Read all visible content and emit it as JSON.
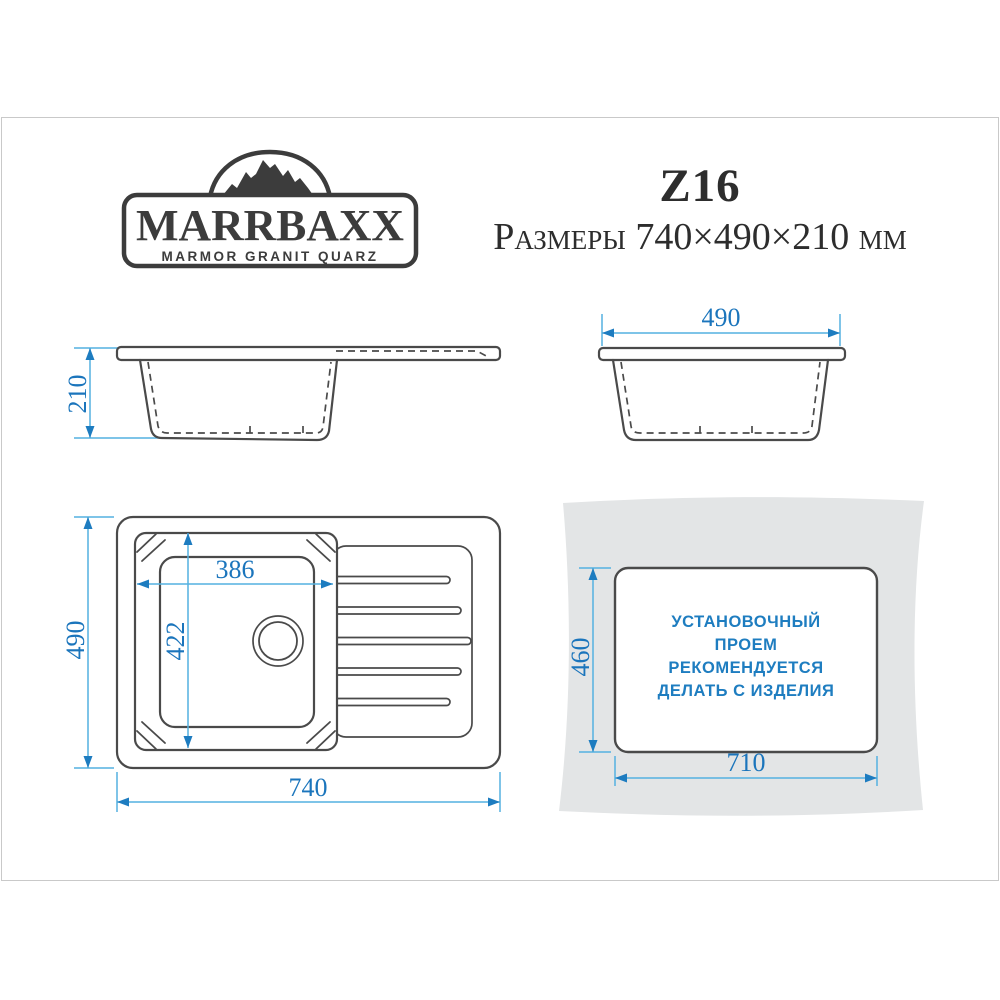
{
  "colors": {
    "outline": "#4a4a4a",
    "dim_line": "#54b1e0",
    "dim_arrow": "#1d7cc0",
    "dim_text": "#1b75bc",
    "note_text": "#1e7dc0",
    "countertop": "#e3e5e6",
    "title_text": "#2d2d2d"
  },
  "logo": {
    "name": "MARRBAXX",
    "tagline": "MARMOR GRANIT QUARZ"
  },
  "header": {
    "model": "Z16",
    "size_line": "Размеры 740×490×210 мм"
  },
  "side_view": {
    "depth": "210"
  },
  "front_view": {
    "width": "490"
  },
  "top_view": {
    "length": "740",
    "width": "490",
    "bowl_length": "386",
    "bowl_width": "422"
  },
  "cutout_view": {
    "length": "710",
    "width": "460",
    "note": [
      "УСТАНОВОЧНЫЙ",
      "ПРОЕМ",
      "РЕКОМЕНДУЕТСЯ",
      "ДЕЛАТЬ С ИЗДЕЛИЯ"
    ]
  }
}
